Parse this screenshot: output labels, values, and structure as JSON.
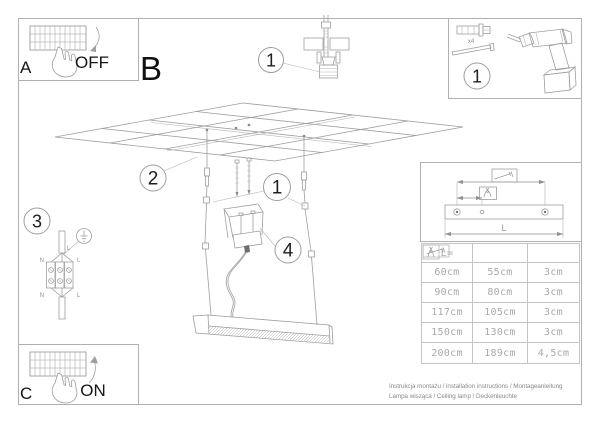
{
  "document": {
    "caption_line1": "Instrukcja montażu / installation instructions / Montageanleitung",
    "caption_line2": "Lampa wisząca / Ceiling lamp / Deckenleuchte"
  },
  "panels": {
    "a": {
      "label": "A",
      "switch_state": "OFF"
    },
    "b": {
      "label": "B"
    },
    "c": {
      "label": "C",
      "switch_state": "ON"
    }
  },
  "callouts": {
    "ceiling_anchor": "1",
    "tools": "1",
    "suspension": "1",
    "ceiling_grid": "2",
    "wiring": "3",
    "canopy": "4"
  },
  "tools": {
    "dowel_quantity": "x4"
  },
  "wiring_labels": {
    "cable": "L",
    "top_left": "N",
    "top_right": "L",
    "bottom_left": "N",
    "bottom_right": "L"
  },
  "dimensions": {
    "length_label": "L"
  },
  "spec_table": {
    "length_header": "L=",
    "col2_icon": "screw-icon",
    "col3_icon": "pliers-icon",
    "rows": [
      [
        "60cm",
        "55cm",
        "3cm"
      ],
      [
        "90cm",
        "80cm",
        "3cm"
      ],
      [
        "117cm",
        "105cm",
        "3cm"
      ],
      [
        "150cm",
        "130cm",
        "3cm"
      ],
      [
        "200cm",
        "189cm",
        "4,5cm"
      ]
    ]
  },
  "colors": {
    "line": "#9e9e9e",
    "dark_text": "#161616",
    "muted_text": "#a9a9a9",
    "caption_text": "#8a8a8a"
  }
}
